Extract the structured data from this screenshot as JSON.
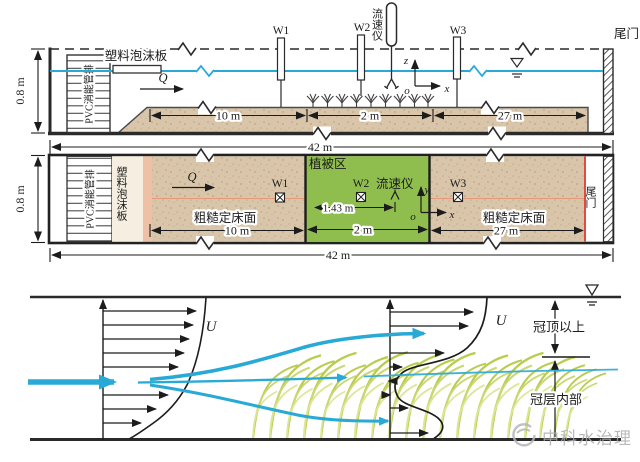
{
  "side": {
    "tailgate": "尾门",
    "foam": "塑料泡沫板",
    "pvc": "PVC消能管排",
    "w1": "W1",
    "w2": "W2",
    "w3": "W3",
    "adv": "流速仪",
    "q": "Q",
    "axis_z": "z",
    "axis_x": "x",
    "axis_o": "o",
    "dim_height": "0.8 m",
    "dim_10": "10 m",
    "dim_2": "2 m",
    "dim_27": "27 m",
    "dim_42": "42 m"
  },
  "plan": {
    "pvc": "PVC消能管排",
    "foam": "塑料泡沫板",
    "veg_zone": "植被区",
    "q": "Q",
    "w1": "W1",
    "w2": "W2",
    "w3": "W3",
    "adv": "流速仪",
    "rough_left": "粗糙定床面",
    "rough_right": "粗糙定床面",
    "tailgate": "尾门",
    "axis_y": "y",
    "axis_x": "x",
    "axis_o": "o",
    "dim_height": "0.8 m",
    "dim_10": "10 m",
    "dim_143": "1.43 m",
    "dim_2": "2 m",
    "dim_27": "27 m",
    "dim_42": "42 m"
  },
  "profile": {
    "u_left": "U",
    "u_right": "U",
    "above_canopy": "冠顶以上",
    "inside_canopy": "冠层内部"
  },
  "watermark": {
    "text": "中科水治理"
  },
  "colors": {
    "water": "#29a9d6",
    "vegetation_zone": "#8fbe4f",
    "sand": "#d9c6aa",
    "canopy_blade": "#b9cc4d",
    "red_marker": "#e23b2e",
    "ink": "#1c1c1c",
    "watermark": "#aeaeae"
  }
}
